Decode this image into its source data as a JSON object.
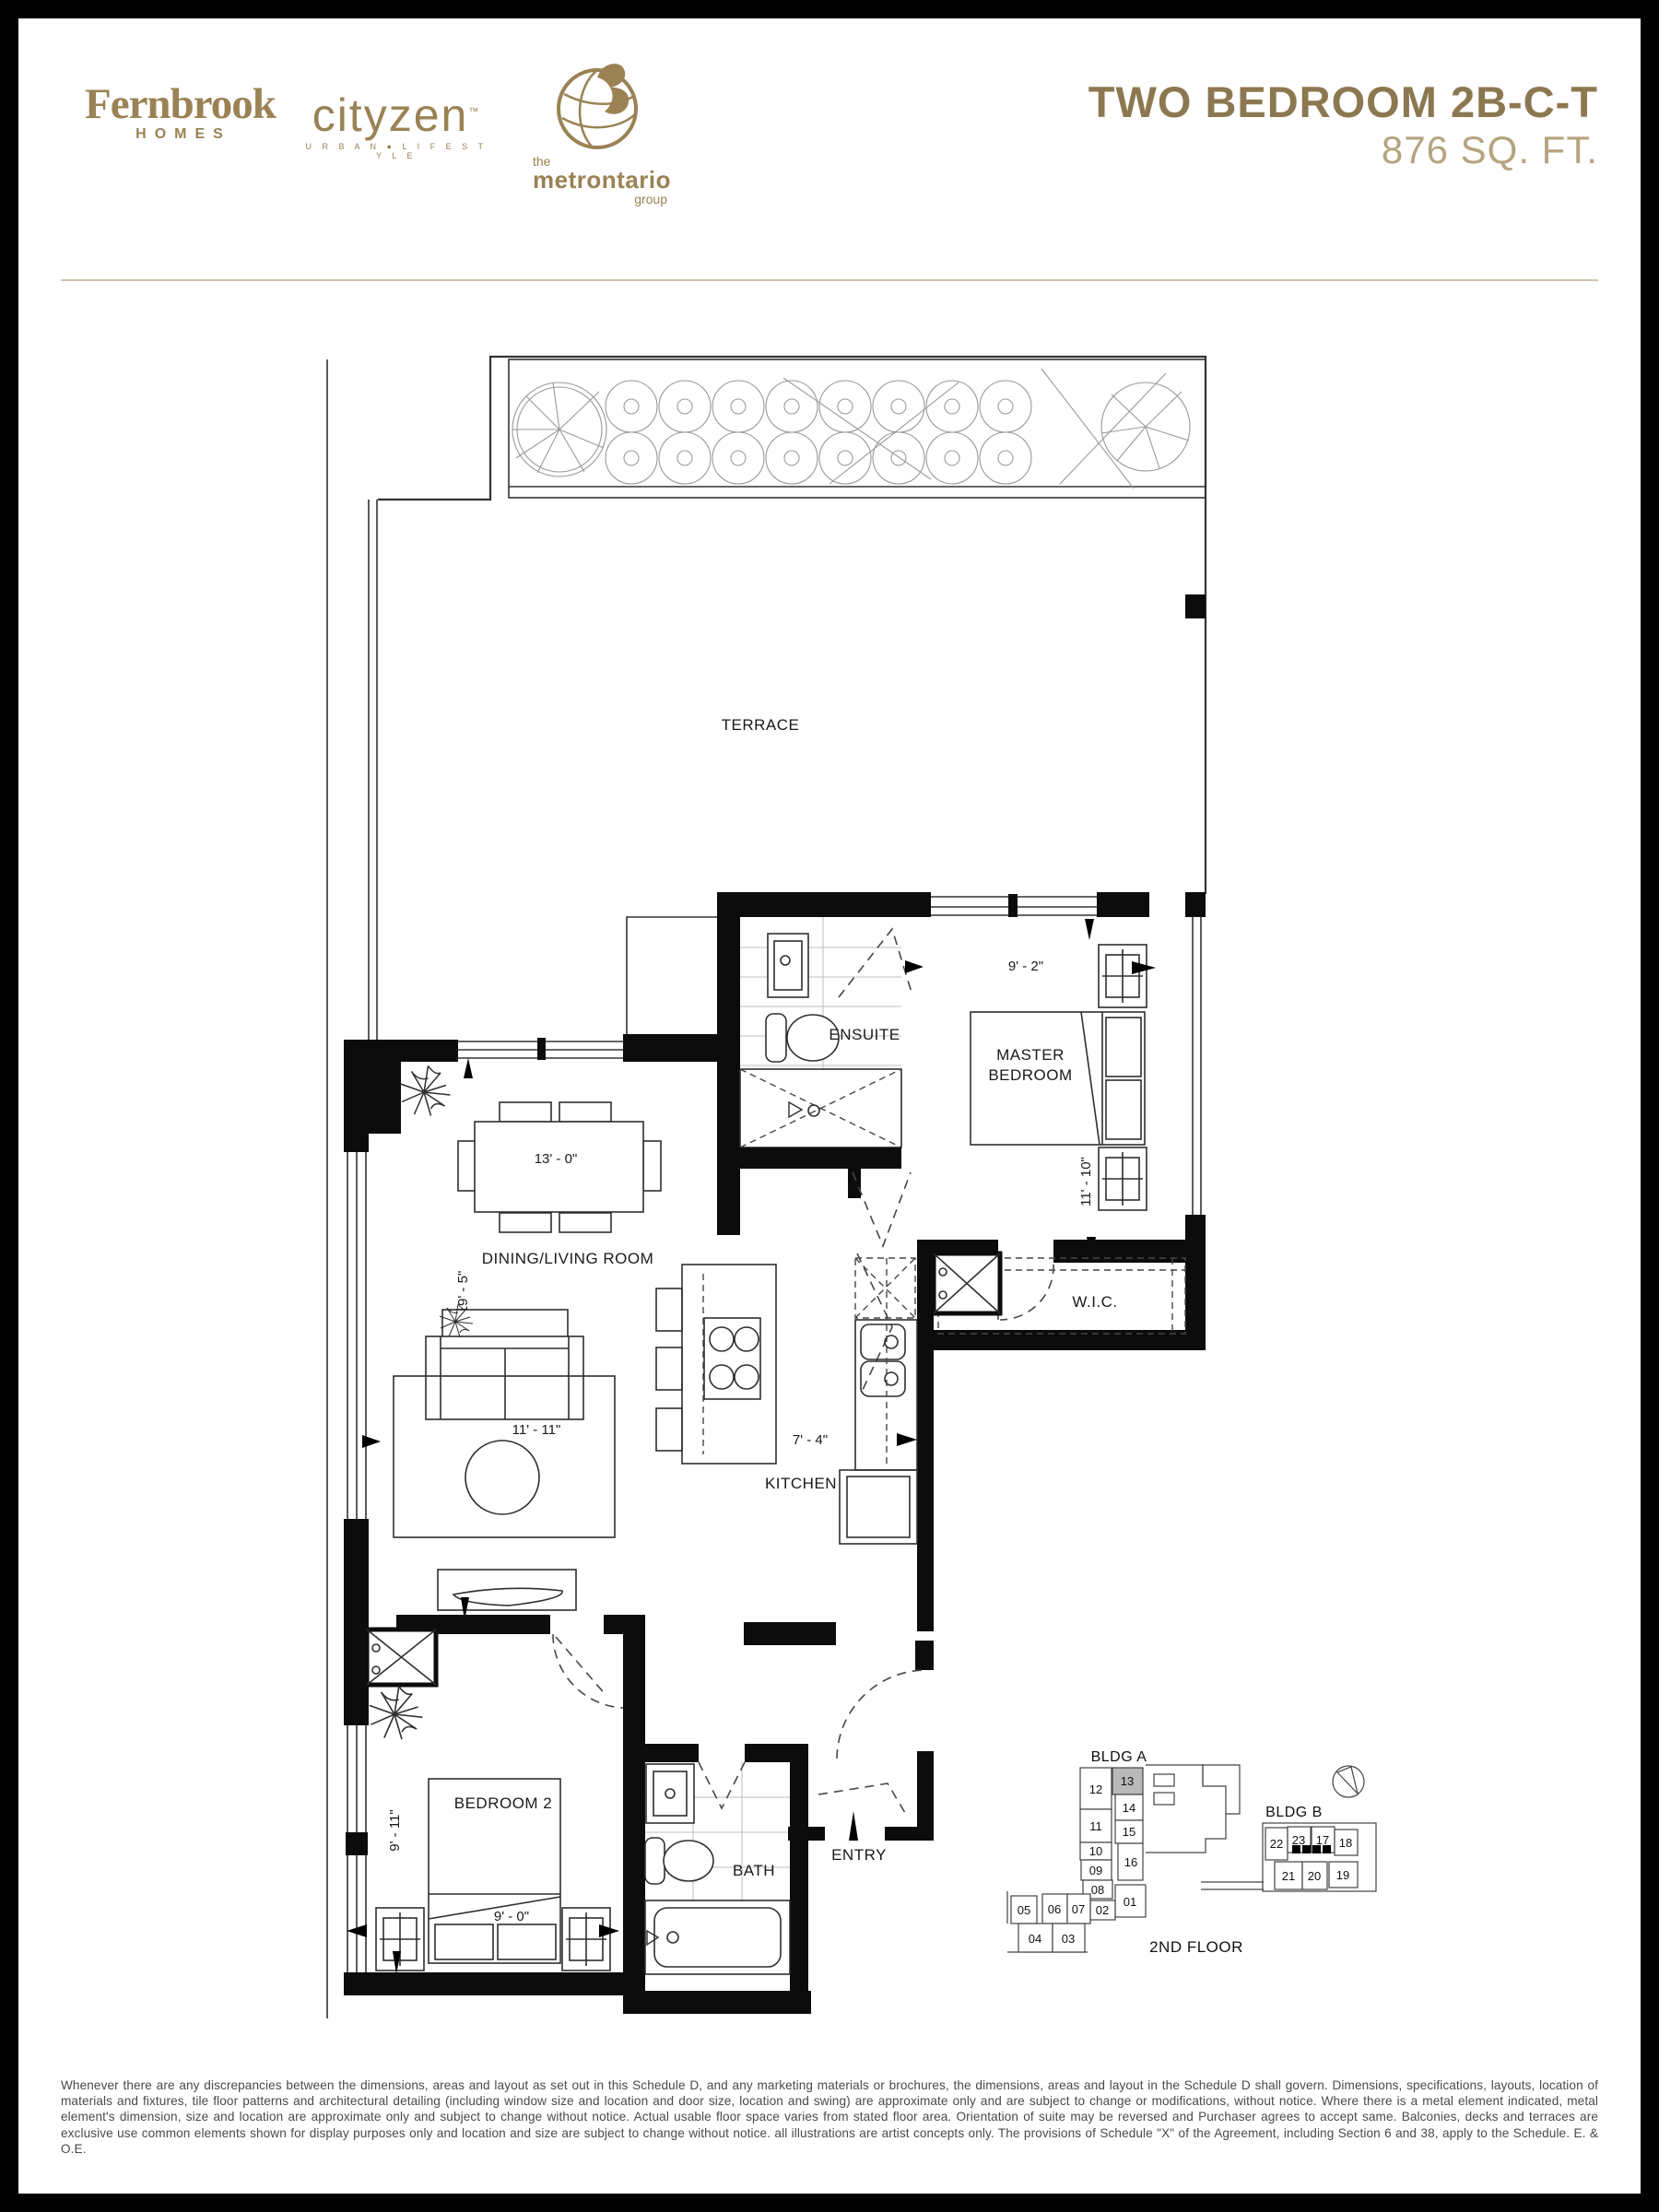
{
  "header": {
    "logos": {
      "fernbrook": {
        "name": "Fernbrook",
        "sub": "HOMES"
      },
      "cityzen": {
        "name": "cityzen",
        "tm": "™",
        "sub": "U R B A N ● L I F E S T Y L E"
      },
      "metrontario": {
        "pre": "the",
        "name": "metrontario",
        "sub": "group"
      }
    },
    "title": "TWO BEDROOM 2B-C-T",
    "subtitle": "876 SQ. FT."
  },
  "plan": {
    "labels": {
      "terrace": "TERRACE",
      "ensuite": "ENSUITE",
      "master_1": "MASTER",
      "master_2": "BEDROOM",
      "dining": "DINING/LIVING ROOM",
      "kitchen": "KITCHEN",
      "wic": "W.I.C.",
      "bedroom2": "BEDROOM 2",
      "bath": "BATH",
      "entry": "ENTRY"
    },
    "dimensions": {
      "master_w": "9' - 2\"",
      "master_h": "11' - 10\"",
      "dining_w": "13' - 0\"",
      "dining_h": "19' - 5\"",
      "living_w": "11' - 11\"",
      "kitchen_w": "7' - 4\"",
      "bedroom2_h": "9' - 11\"",
      "bedroom2_w": "9' - 0\""
    }
  },
  "keyplan": {
    "bldg_a": "BLDG A",
    "bldg_b": "BLDG B",
    "floor": "2ND FLOOR",
    "highlighted_unit": "13",
    "units": [
      {
        "label": "12"
      },
      {
        "label": "13"
      },
      {
        "label": "14"
      },
      {
        "label": "11"
      },
      {
        "label": "15"
      },
      {
        "label": "10"
      },
      {
        "label": "16"
      },
      {
        "label": "09"
      },
      {
        "label": "08"
      },
      {
        "label": "01"
      },
      {
        "label": "02"
      },
      {
        "label": "05"
      },
      {
        "label": "06"
      },
      {
        "label": "07"
      },
      {
        "label": "04"
      },
      {
        "label": "03"
      },
      {
        "label": "22"
      },
      {
        "label": "23"
      },
      {
        "label": "17"
      },
      {
        "label": "18"
      },
      {
        "label": "21"
      },
      {
        "label": "20"
      },
      {
        "label": "19"
      }
    ]
  },
  "footer": {
    "disclaimer": "Whenever there are any discrepancies between the dimensions, areas and layout as set out in this Schedule D, and any marketing materials or brochures, the dimensions, areas and layout in the Schedule D shall govern. Dimensions, specifications, layouts, location of materials and fixtures, tile floor patterns and architectural detailing (including window size and location and door size, location and swing) are approximate only and are subject to change or modifications, without notice. Where there is a metal element indicated, metal element's dimension, size and location are approximate only and subject to change without notice. Actual usable floor space varies from stated floor area. Orientation of suite may be reversed and Purchaser agrees to accept same. Balconies, decks and terraces are exclusive use common elements shown for display purposes only and location and size are subject to change without notice. all illustrations are artist concepts only. The provisions of Schedule \"X\" of the Agreement, including Section 6 and 38, apply to the Schedule. E. & O.E."
  },
  "colors": {
    "gold": "#9a8254",
    "title": "#8c7850",
    "subtitle": "#b5a47e",
    "rule": "#cfc4aa",
    "wall": "#0c0c0c",
    "line": "#333333",
    "text": "#1a1a1a",
    "footer": "#4a4a4a"
  }
}
